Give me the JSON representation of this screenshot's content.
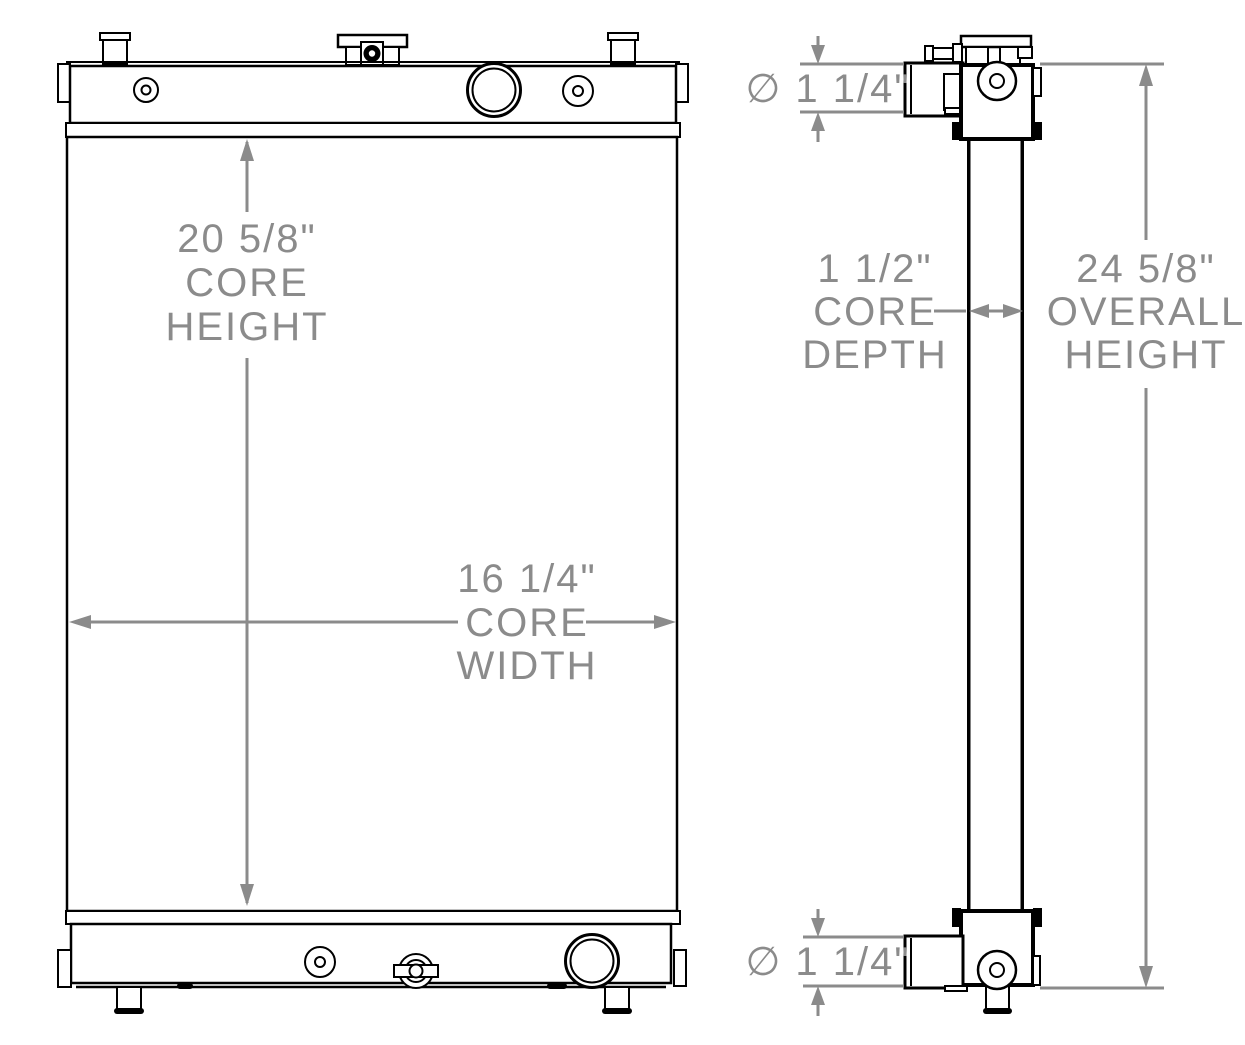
{
  "title": "Radiator dimensional drawing",
  "colors": {
    "line": "#000000",
    "dimension": "#8b8b8b",
    "background": "#ffffff"
  },
  "dimensions": {
    "core_height": {
      "value": "20 5/8\"",
      "line1": "CORE",
      "line2": "HEIGHT"
    },
    "core_width": {
      "value": "16 1/4\"",
      "line1": "CORE",
      "line2": "WIDTH"
    },
    "core_depth": {
      "value": "1 1/2\"",
      "line1": "CORE",
      "line2": "DEPTH"
    },
    "overall_height": {
      "value": "24 5/8\"",
      "line1": "OVERALL",
      "line2": "HEIGHT"
    },
    "top_port_diameter": {
      "value": "∅ 1 1/4\""
    },
    "bottom_port_diameter": {
      "value": "∅ 1 1/4\""
    }
  }
}
